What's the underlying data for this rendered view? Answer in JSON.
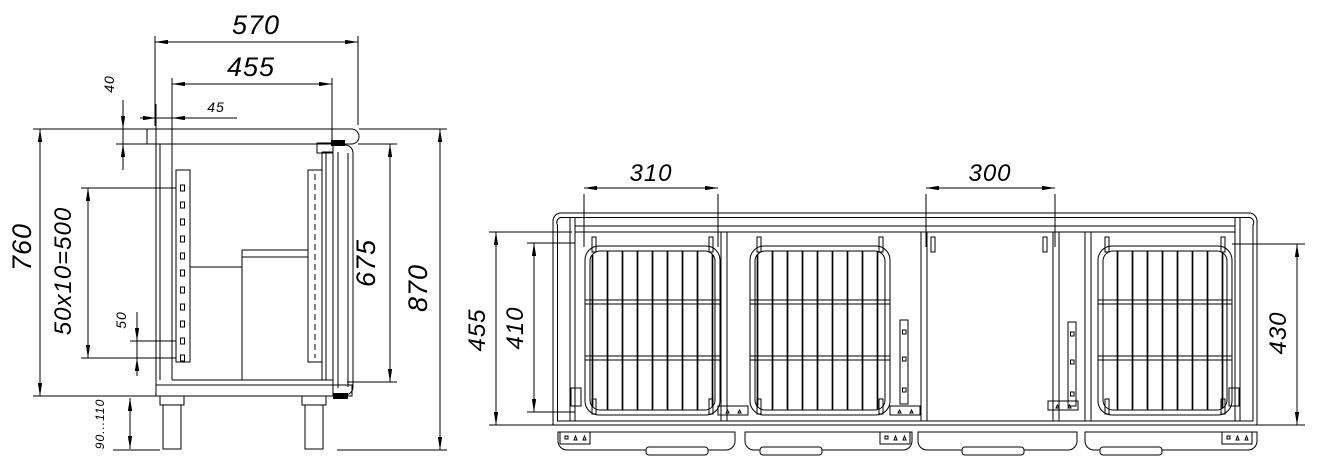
{
  "side_view": {
    "overall_depth": "570",
    "inner_depth": "455",
    "wall_offset": "45",
    "worktop_thickness": "40",
    "body_height": "760",
    "shelf_rail_pitch": "50x10=500",
    "slot_pitch": "50",
    "leg_height_range": "90...110",
    "door_height": "675",
    "overall_height": "870"
  },
  "front_view": {
    "shelf_bay_width": "310",
    "machine_bay_width": "300",
    "inner_height": "455",
    "shelf_opening_height": "410",
    "right_opening_height": "430"
  }
}
